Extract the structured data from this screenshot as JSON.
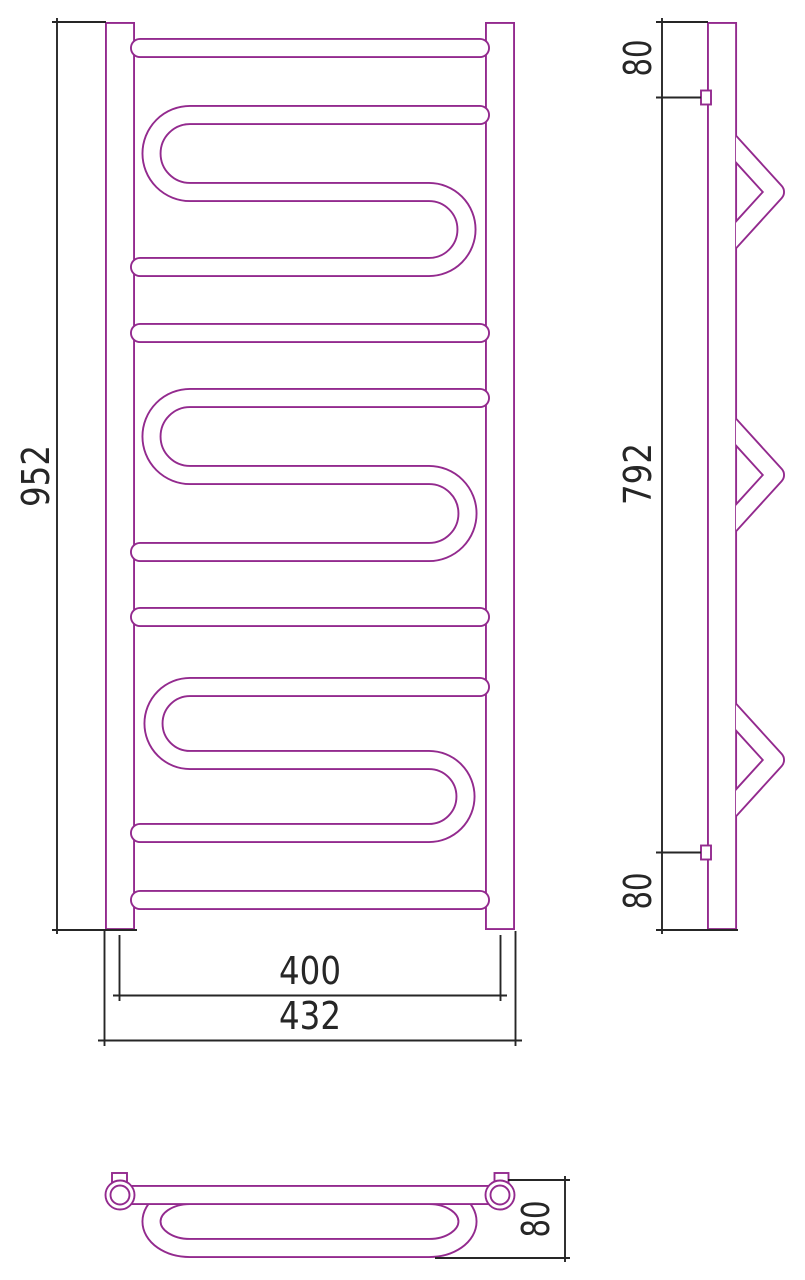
{
  "drawing": {
    "title": "towel-rail-technical-drawing",
    "views": {
      "front": {
        "dimensions": {
          "height": "952",
          "center_distance": "400",
          "overall_width": "432"
        }
      },
      "side": {
        "dimensions": {
          "top_offset": "80",
          "bracket_distance": "792",
          "bottom_offset": "80"
        }
      },
      "bottom": {
        "dimensions": {
          "depth": "80"
        }
      }
    },
    "colors": {
      "tube_outline": "#932A8E",
      "dimension_lines": "#262626",
      "background": "#FFFFFF"
    }
  }
}
